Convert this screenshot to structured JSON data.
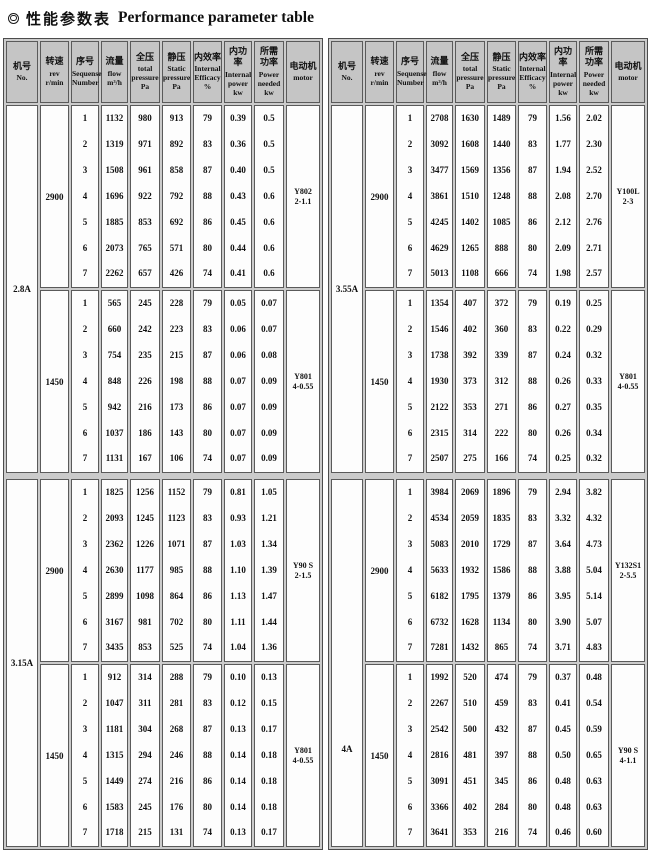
{
  "title": {
    "icon": "bullseye-icon",
    "zh": "性能参数表",
    "en": "Performance parameter table"
  },
  "table": {
    "headers": [
      {
        "zh": "机号",
        "en": "No."
      },
      {
        "zh": "转速",
        "en": "rev\nr/min"
      },
      {
        "zh": "序号",
        "en": "Sequense\nNumber"
      },
      {
        "zh": "流量",
        "en": "flow\nm³/h"
      },
      {
        "zh": "全压",
        "en": "total\npressure\nPa"
      },
      {
        "zh": "静压",
        "en": "Static\npressure\nPa"
      },
      {
        "zh": "内效率",
        "en": "Internal\nEfficacy\n%"
      },
      {
        "zh": "内功率",
        "en": "Internal\npower\nkw"
      },
      {
        "zh": "所需\n功率",
        "en": "Power\nneeded\nkw"
      },
      {
        "zh": "电动机",
        "en": "motor"
      }
    ],
    "colors": {
      "header_bg": "#c5c5c5",
      "model_col_bg": "#e3e3e3",
      "cell_bg": "#fdfdfd",
      "grid_gap": "#cbcbcb",
      "border": "#5a5a5a",
      "text": "#101010"
    }
  },
  "tables": [
    {
      "sections": [
        {
          "model": "2.8A",
          "blocks": [
            {
              "speed": "2900",
              "motor": [
                "Y802",
                "2-1.1"
              ],
              "rows": [
                [
                  "1",
                  "1132",
                  "980",
                  "913",
                  "79",
                  "0.39",
                  "0.5"
                ],
                [
                  "2",
                  "1319",
                  "971",
                  "892",
                  "83",
                  "0.36",
                  "0.5"
                ],
                [
                  "3",
                  "1508",
                  "961",
                  "858",
                  "87",
                  "0.40",
                  "0.5"
                ],
                [
                  "4",
                  "1696",
                  "922",
                  "792",
                  "88",
                  "0.43",
                  "0.6"
                ],
                [
                  "5",
                  "1885",
                  "853",
                  "692",
                  "86",
                  "0.45",
                  "0.6"
                ],
                [
                  "6",
                  "2073",
                  "765",
                  "571",
                  "80",
                  "0.44",
                  "0.6"
                ],
                [
                  "7",
                  "2262",
                  "657",
                  "426",
                  "74",
                  "0.41",
                  "0.6"
                ]
              ]
            },
            {
              "speed": "1450",
              "motor": [
                "Y801",
                "4-0.55"
              ],
              "rows": [
                [
                  "1",
                  "565",
                  "245",
                  "228",
                  "79",
                  "0.05",
                  "0.07"
                ],
                [
                  "2",
                  "660",
                  "242",
                  "223",
                  "83",
                  "0.06",
                  "0.07"
                ],
                [
                  "3",
                  "754",
                  "235",
                  "215",
                  "87",
                  "0.06",
                  "0.08"
                ],
                [
                  "4",
                  "848",
                  "226",
                  "198",
                  "88",
                  "0.07",
                  "0.09"
                ],
                [
                  "5",
                  "942",
                  "216",
                  "173",
                  "86",
                  "0.07",
                  "0.09"
                ],
                [
                  "6",
                  "1037",
                  "186",
                  "143",
                  "80",
                  "0.07",
                  "0.09"
                ],
                [
                  "7",
                  "1131",
                  "167",
                  "106",
                  "74",
                  "0.07",
                  "0.09"
                ]
              ]
            }
          ]
        },
        {
          "model": "3.15A",
          "blocks": [
            {
              "speed": "2900",
              "motor": [
                "Y90 S",
                "2-1.5"
              ],
              "rows": [
                [
                  "1",
                  "1825",
                  "1256",
                  "1152",
                  "79",
                  "0.81",
                  "1.05"
                ],
                [
                  "2",
                  "2093",
                  "1245",
                  "1123",
                  "83",
                  "0.93",
                  "1.21"
                ],
                [
                  "3",
                  "2362",
                  "1226",
                  "1071",
                  "87",
                  "1.03",
                  "1.34"
                ],
                [
                  "4",
                  "2630",
                  "1177",
                  "985",
                  "88",
                  "1.10",
                  "1.39"
                ],
                [
                  "5",
                  "2899",
                  "1098",
                  "864",
                  "86",
                  "1.13",
                  "1.47"
                ],
                [
                  "6",
                  "3167",
                  "981",
                  "702",
                  "80",
                  "1.11",
                  "1.44"
                ],
                [
                  "7",
                  "3435",
                  "853",
                  "525",
                  "74",
                  "1.04",
                  "1.36"
                ]
              ]
            },
            {
              "speed": "1450",
              "motor": [
                "Y801",
                "4-0.55"
              ],
              "rows": [
                [
                  "1",
                  "912",
                  "314",
                  "288",
                  "79",
                  "0.10",
                  "0.13"
                ],
                [
                  "2",
                  "1047",
                  "311",
                  "281",
                  "83",
                  "0.12",
                  "0.15"
                ],
                [
                  "3",
                  "1181",
                  "304",
                  "268",
                  "87",
                  "0.13",
                  "0.17"
                ],
                [
                  "4",
                  "1315",
                  "294",
                  "246",
                  "88",
                  "0.14",
                  "0.18"
                ],
                [
                  "5",
                  "1449",
                  "274",
                  "216",
                  "86",
                  "0.14",
                  "0.18"
                ],
                [
                  "6",
                  "1583",
                  "245",
                  "176",
                  "80",
                  "0.14",
                  "0.18"
                ],
                [
                  "7",
                  "1718",
                  "215",
                  "131",
                  "74",
                  "0.13",
                  "0.17"
                ]
              ]
            }
          ]
        }
      ]
    },
    {
      "sections": [
        {
          "model": "3.55A",
          "blocks": [
            {
              "speed": "2900",
              "motor": [
                "Y100L",
                "2-3"
              ],
              "rows": [
                [
                  "1",
                  "2708",
                  "1630",
                  "1489",
                  "79",
                  "1.56",
                  "2.02"
                ],
                [
                  "2",
                  "3092",
                  "1608",
                  "1440",
                  "83",
                  "1.77",
                  "2.30"
                ],
                [
                  "3",
                  "3477",
                  "1569",
                  "1356",
                  "87",
                  "1.94",
                  "2.52"
                ],
                [
                  "4",
                  "3861",
                  "1510",
                  "1248",
                  "88",
                  "2.08",
                  "2.70"
                ],
                [
                  "5",
                  "4245",
                  "1402",
                  "1085",
                  "86",
                  "2.12",
                  "2.76"
                ],
                [
                  "6",
                  "4629",
                  "1265",
                  "888",
                  "80",
                  "2.09",
                  "2.71"
                ],
                [
                  "7",
                  "5013",
                  "1108",
                  "666",
                  "74",
                  "1.98",
                  "2.57"
                ]
              ]
            },
            {
              "speed": "1450",
              "motor": [
                "Y801",
                "4-0.55"
              ],
              "rows": [
                [
                  "1",
                  "1354",
                  "407",
                  "372",
                  "79",
                  "0.19",
                  "0.25"
                ],
                [
                  "2",
                  "1546",
                  "402",
                  "360",
                  "83",
                  "0.22",
                  "0.29"
                ],
                [
                  "3",
                  "1738",
                  "392",
                  "339",
                  "87",
                  "0.24",
                  "0.32"
                ],
                [
                  "4",
                  "1930",
                  "373",
                  "312",
                  "88",
                  "0.26",
                  "0.33"
                ],
                [
                  "5",
                  "2122",
                  "353",
                  "271",
                  "86",
                  "0.27",
                  "0.35"
                ],
                [
                  "6",
                  "2315",
                  "314",
                  "222",
                  "80",
                  "0.26",
                  "0.34"
                ],
                [
                  "7",
                  "2507",
                  "275",
                  "166",
                  "74",
                  "0.25",
                  "0.32"
                ]
              ]
            }
          ]
        },
        {
          "model": "4A",
          "model_offset": "low",
          "blocks": [
            {
              "speed": "2900",
              "motor": [
                "Y132S1",
                "2-5.5"
              ],
              "rows": [
                [
                  "1",
                  "3984",
                  "2069",
                  "1896",
                  "79",
                  "2.94",
                  "3.82"
                ],
                [
                  "2",
                  "4534",
                  "2059",
                  "1835",
                  "83",
                  "3.32",
                  "4.32"
                ],
                [
                  "3",
                  "5083",
                  "2010",
                  "1729",
                  "87",
                  "3.64",
                  "4.73"
                ],
                [
                  "4",
                  "5633",
                  "1932",
                  "1586",
                  "88",
                  "3.88",
                  "5.04"
                ],
                [
                  "5",
                  "6182",
                  "1795",
                  "1379",
                  "86",
                  "3.95",
                  "5.14"
                ],
                [
                  "6",
                  "6732",
                  "1628",
                  "1134",
                  "80",
                  "3.90",
                  "5.07"
                ],
                [
                  "7",
                  "7281",
                  "1432",
                  "865",
                  "74",
                  "3.71",
                  "4.83"
                ]
              ]
            },
            {
              "speed": "1450",
              "motor": [
                "Y90 S",
                "4-1.1"
              ],
              "rows": [
                [
                  "1",
                  "1992",
                  "520",
                  "474",
                  "79",
                  "0.37",
                  "0.48"
                ],
                [
                  "2",
                  "2267",
                  "510",
                  "459",
                  "83",
                  "0.41",
                  "0.54"
                ],
                [
                  "3",
                  "2542",
                  "500",
                  "432",
                  "87",
                  "0.45",
                  "0.59"
                ],
                [
                  "4",
                  "2816",
                  "481",
                  "397",
                  "88",
                  "0.50",
                  "0.65"
                ],
                [
                  "5",
                  "3091",
                  "451",
                  "345",
                  "86",
                  "0.48",
                  "0.63"
                ],
                [
                  "6",
                  "3366",
                  "402",
                  "284",
                  "80",
                  "0.48",
                  "0.63"
                ],
                [
                  "7",
                  "3641",
                  "353",
                  "216",
                  "74",
                  "0.46",
                  "0.60"
                ]
              ]
            }
          ]
        }
      ]
    }
  ]
}
